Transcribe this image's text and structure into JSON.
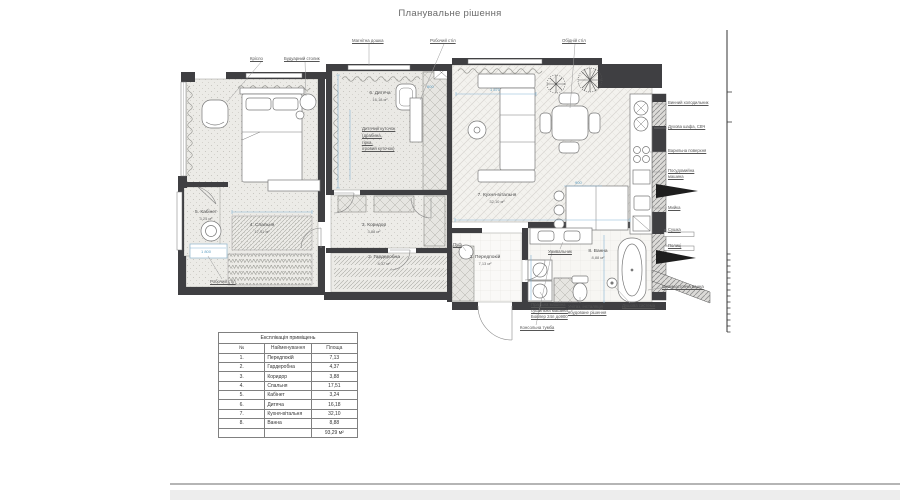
{
  "page": {
    "title": "Планувальне рішення"
  },
  "plan": {
    "rooms": {
      "peredpokii": {
        "name": "1. Передпокій",
        "area": "7,13 м²"
      },
      "harderobna": {
        "name": "2. Гардеробна",
        "area": "4,37 м²"
      },
      "korydor": {
        "name": "3. Коридор",
        "area": "3,88 м²"
      },
      "spalnia": {
        "name": "4. Спальня",
        "area": "17,51 м²"
      },
      "kabinet": {
        "name": "5. Кабінет",
        "area": "3,24 м²"
      },
      "dytiacha": {
        "name": "6. Дитяча",
        "area": "16,18 м²"
      },
      "kukhnia": {
        "name": "7. Кухня-вітальня",
        "area": "32,10 м²"
      },
      "vanna": {
        "name": "8. Ванна",
        "area": "8,88 м²"
      }
    },
    "callouts": {
      "armchair": "Крісло",
      "boudoir_table": "Будуарний столик",
      "magnetic_board": "Магнітна дошка",
      "work_desk_top": "Робочий стіл",
      "dining_table": "Обідній стіл",
      "work_desk_left": "Робочий стіл",
      "pouf": "Пуф",
      "sink_vanity": "Умивальник",
      "washer_line1": "Пральна машина",
      "washer_line2": "сушильна машина",
      "washer_line3": "Бойлер 24л до900",
      "toilet_line1": "Унітаз, інсталяція",
      "toilet_line2": "вбудоване рішення",
      "shower": "Душова система",
      "console": "Консольна тумба",
      "freestanding_bath": "Окремостояча ванна",
      "kids_corner_line1": "Дитячий куточок",
      "kids_corner_line2": "(драбина,",
      "kids_corner_line3": "гірка,",
      "kids_corner_line4": "ігровий куточок)"
    },
    "kitchen_labels": [
      "Винний холодильник",
      "Духова шафа, СВЧ",
      "Варильна поверхня",
      "Посудомийна машина",
      "Мийка",
      "Сушка",
      "Полиці"
    ],
    "dimensions": {
      "desk": "1 800",
      "sofa": "1 570",
      "island": "900",
      "closet": "600"
    }
  },
  "table": {
    "title": "Експлікація приміщень",
    "headers": {
      "num": "№",
      "name": "Найменування",
      "area": "Площа"
    },
    "rows": [
      {
        "n": "1.",
        "name": "Передпокій",
        "area": "7,13"
      },
      {
        "n": "2.",
        "name": "Гардеробна",
        "area": "4,37"
      },
      {
        "n": "3.",
        "name": "Коридор",
        "area": "3,88"
      },
      {
        "n": "4.",
        "name": "Спальня",
        "area": "17,51"
      },
      {
        "n": "5.",
        "name": "Кабінет",
        "area": "3,24"
      },
      {
        "n": "6.",
        "name": "Дитяча",
        "area": "16,18"
      },
      {
        "n": "7.",
        "name": "Кухня-вітальня",
        "area": "32,10"
      },
      {
        "n": "8.",
        "name": "Ванна",
        "area": "8,88"
      }
    ],
    "total": "93,29 м²"
  },
  "colors": {
    "wall": "#3f3f42",
    "dimension_blue": "#7fafcf",
    "floor": "#ecebe7"
  }
}
